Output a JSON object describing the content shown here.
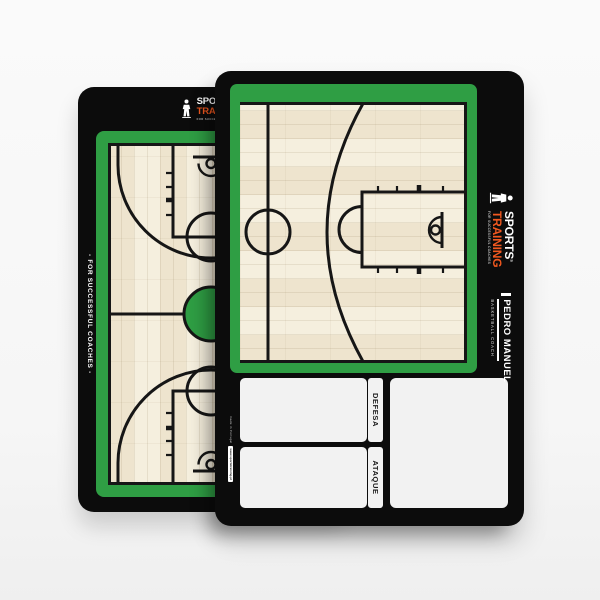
{
  "colors": {
    "green": "#2f9e44",
    "orange": "#f1581f",
    "board_black": "#0c0c0c",
    "court_wood": "#f5efde",
    "panel_white": "#f2f2f2",
    "line_black": "#161616"
  },
  "back_board": {
    "side_text": "- FOR SUCCESSFUL COACHES -",
    "logo": {
      "line1": "SPORTS",
      "reg": "®",
      "line2": "TRAINING",
      "tagline": "FOR SUCCESSFUL COACHES"
    }
  },
  "front_board": {
    "logo": {
      "line1": "SPORTS",
      "reg": "®",
      "line2": "TRAINING",
      "tagline": "FOR SUCCESSFUL COACHES"
    },
    "coach_name": "PEDRO MANUEL",
    "coach_title": "BASKETBALL COACH",
    "panels": {
      "defense_label": "DEFESA",
      "attack_label": "ATAQUE"
    },
    "footer": {
      "made_in": "made in Portugal",
      "website": "www.sportstraining.pt"
    }
  }
}
